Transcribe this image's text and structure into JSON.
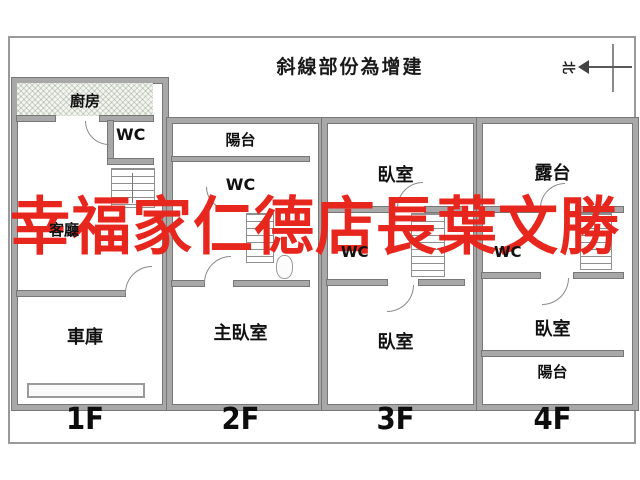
{
  "title": "斜線部份為增建",
  "compass": {
    "north_label": "北"
  },
  "watermark": {
    "text": "幸福家仁德店長葉文勝",
    "color": "#e7261d"
  },
  "floors": [
    {
      "label": "1F",
      "rooms": {
        "kitchen": "廚房",
        "wc": "WC",
        "living": "客廳",
        "garage": "車庫"
      }
    },
    {
      "label": "2F",
      "rooms": {
        "balcony": "陽台",
        "wc": "WC",
        "master_bedroom": "主臥室"
      }
    },
    {
      "label": "3F",
      "rooms": {
        "bedroom_front": "臥室",
        "wc": "WC",
        "bedroom_back": "臥室"
      }
    },
    {
      "label": "4F",
      "rooms": {
        "terrace": "露台",
        "wc": "WC",
        "bedroom": "臥室",
        "balcony": "陽台"
      }
    }
  ],
  "colors": {
    "watermark_red": "#e7261d",
    "wall_gray": "#a8a8a8",
    "wall_edge": "#777777",
    "hatch_fill": "#f3f5ef",
    "frame_border": "#9a9a9a"
  }
}
